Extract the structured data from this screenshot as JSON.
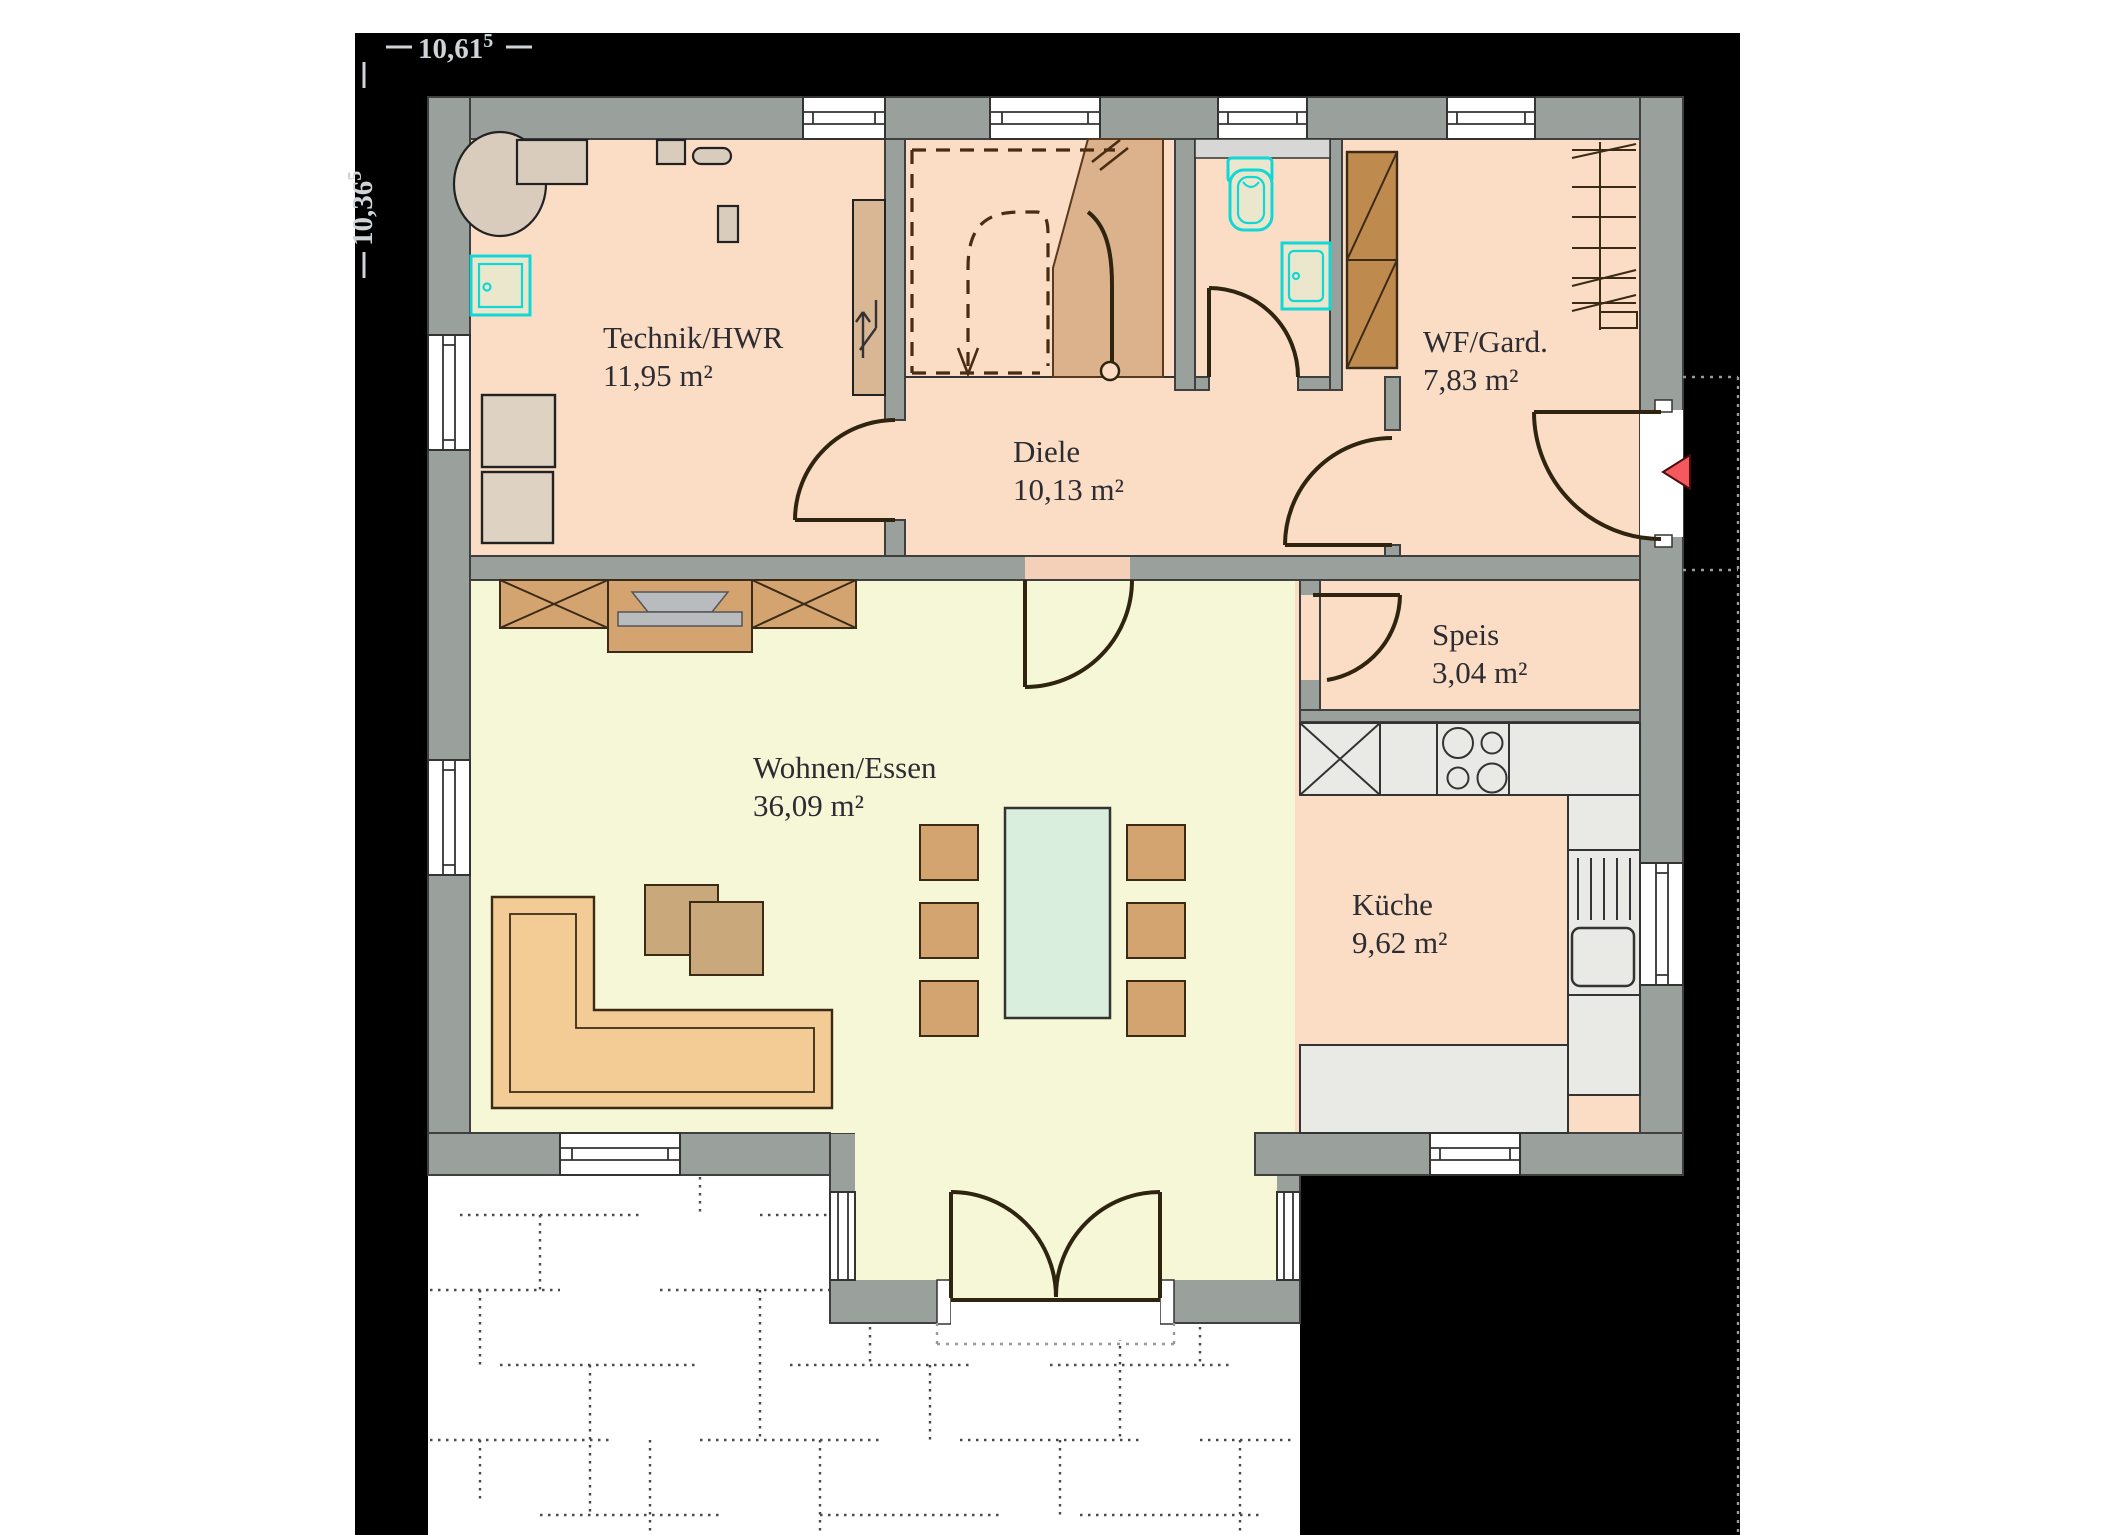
{
  "plan": {
    "dimensions": {
      "width": {
        "value": "10,61",
        "sup": "5"
      },
      "height": {
        "value": "10,36",
        "sup": "5"
      }
    },
    "rooms": [
      {
        "name": "Technik/HWR",
        "area": "11,95 m²"
      },
      {
        "name": "Diele",
        "area": "10,13 m²"
      },
      {
        "name": "WF/Gard.",
        "area": "7,83 m²"
      },
      {
        "name": "Speis",
        "area": "3,04 m²"
      },
      {
        "name": "Wohnen/Essen",
        "area": "36,09 m²"
      },
      {
        "name": "Küche",
        "area": "9,62 m²"
      }
    ],
    "entrance_marker": "entrance-arrow"
  },
  "palette": {
    "wall": "#9aa19c",
    "peach": "#fbddc5",
    "peachDark": "#f4d0b8",
    "yellow": "#f6f7d7",
    "counter": "#e9e9e6",
    "tan": "#d4a470",
    "tanDark": "#c9a87b",
    "beige": "#d9ccbd",
    "washer": "#ded2c3",
    "brown": "#bf8a4e",
    "stair": "#dcb28c",
    "mint": "#d9eedd",
    "cyan": "#13d6d6",
    "fixture": "#eae7cc",
    "red": "#f4595f",
    "ink": "#2c2c32",
    "dimText": "#cfd4d8",
    "doorArc": "#2f2410",
    "dash": "#4a2c12",
    "tv": "#b9bcbe",
    "frame": "#000000"
  }
}
